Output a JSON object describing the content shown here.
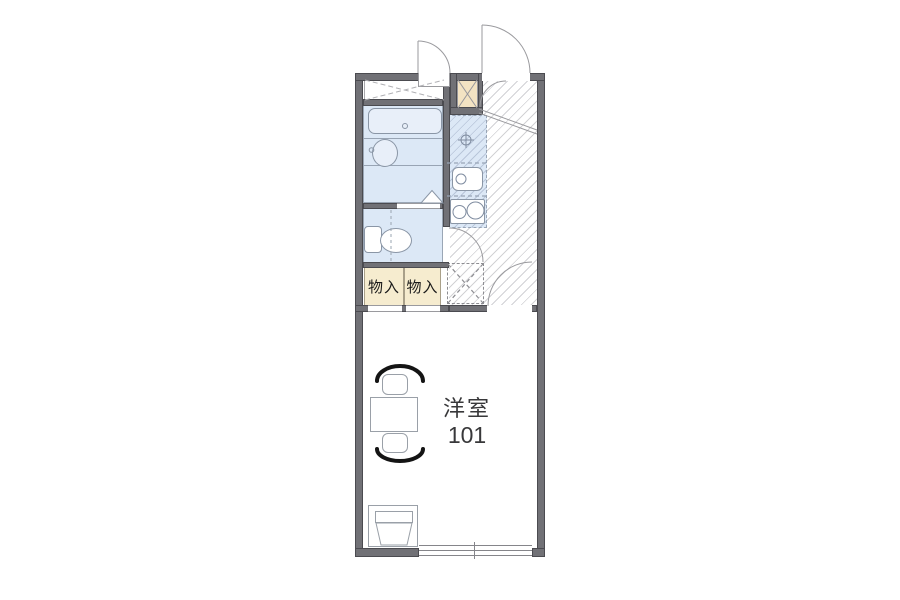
{
  "floorplan": {
    "main_room": {
      "label": "洋室",
      "number": "101"
    },
    "closets": [
      {
        "label": "物入"
      },
      {
        "label": "物入"
      }
    ],
    "colors": {
      "wall": "#717176",
      "wet_area_fill": "#dce8f6",
      "closet_fill": "#f6eccf",
      "utility_box_fill": "#f3e3c3",
      "hallway_hatch_line": "#d2d2d5",
      "kitchen_hatch_line": "#b9c6da",
      "chair_arc": "#141414"
    }
  }
}
